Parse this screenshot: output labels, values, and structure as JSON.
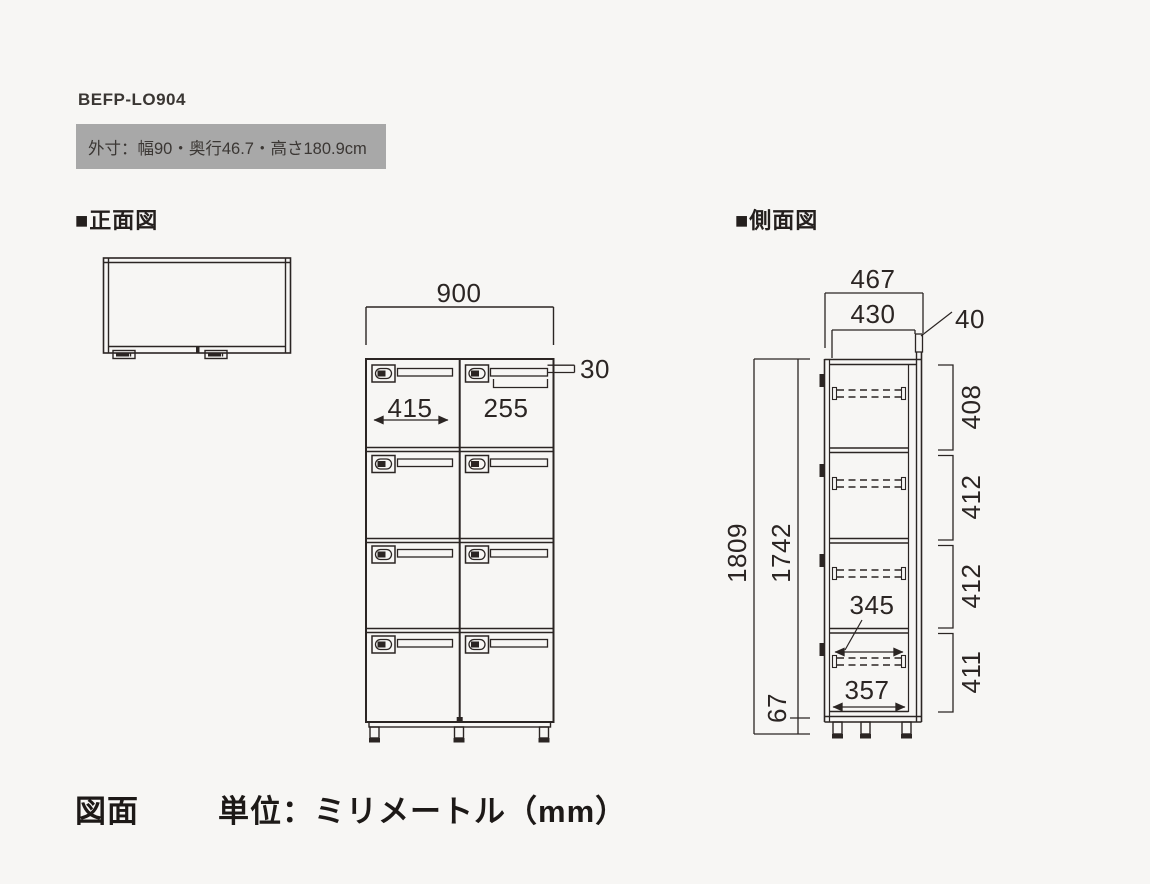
{
  "product": {
    "code": "BEFP-LO904",
    "outer_dimensions": "外寸：幅90・奥行46.7・高さ180.9cm"
  },
  "views": {
    "front": {
      "label": "■正面図",
      "dimensions": {
        "overall_width": "900",
        "door_width": "415",
        "nameplate_width": "255",
        "nameplate_height": "30"
      }
    },
    "side": {
      "label": "■側面図",
      "dimensions": {
        "overall_depth": "467",
        "inner_depth": "430",
        "back_rail": "40",
        "overall_height": "1809",
        "body_height": "1742",
        "base_height": "67",
        "compartments": [
          "408",
          "412",
          "412",
          "411"
        ],
        "hanger_rail_length": "345",
        "interior_depth": "357"
      }
    }
  },
  "footer": {
    "drawing_label": "図面",
    "unit_label": "単位：ミリメートル（mm）"
  },
  "colors": {
    "background": "#f7f6f4",
    "line": "#2b2523",
    "dims_box_bg": "#a8a8a8"
  },
  "unit": "mm"
}
